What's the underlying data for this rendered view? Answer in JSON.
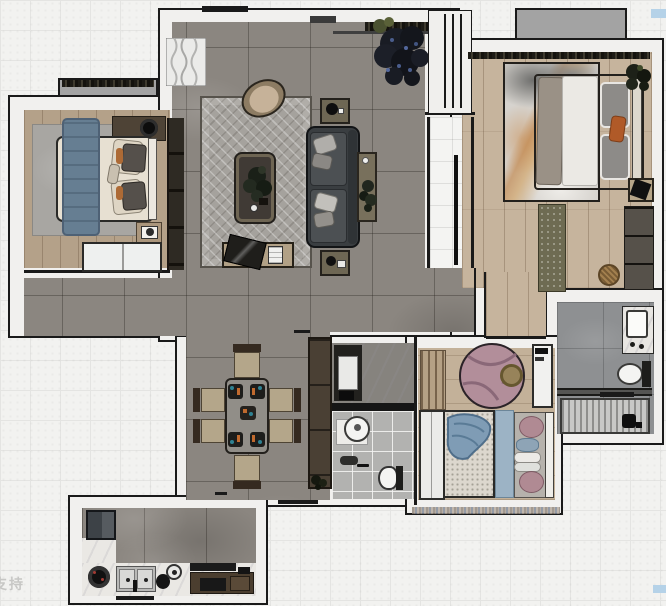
{
  "document": {
    "type": "apartment-floor-plan-render",
    "view": "top-down",
    "watermark": {
      "bottom_left": "支持"
    }
  },
  "palette": {
    "wall_fill": "#f1f0ee",
    "wall_outline": "#1a1a1a",
    "living_floor": "#8b8680",
    "wood_master": "#c6b49d",
    "wood_bedroom": "#b4a189",
    "rug_living": "#a5a29d",
    "sofa": "#3a3e41",
    "accent_orange": "#b4662e",
    "accent_blue": "#7f9cb5",
    "kids_rug_pink": "#b28e9a",
    "bay_window": "#a3a3a3",
    "exterior_tile": "#f2f2f0",
    "artifact_blue": "#b5d2e8"
  },
  "rooms": [
    {
      "name": "living-room",
      "floor": "gray-marble-tile",
      "furniture": [
        "curtain",
        "herringbone-rug",
        "armchair",
        "coffee-table",
        "coffee-table-plant",
        "tv-bench",
        "tv-panel",
        "media-item",
        "tv-wall-cabinet",
        "sofa",
        "sofa-cushions",
        "side-table-top",
        "side-table-bottom",
        "console-table",
        "console-plant",
        "large-potted-plant",
        "window-sill-planter",
        "entry-door-unit"
      ]
    },
    {
      "name": "bedroom-secondary",
      "floor": "wood-plank",
      "furniture": [
        "bay-window",
        "area-rug",
        "double-bed",
        "blue-throw-blanket",
        "pillows",
        "headboard",
        "top-counter-with-speaker",
        "nightstand-with-book",
        "white-dresser"
      ]
    },
    {
      "name": "master-bedroom",
      "floor": "wood-plank",
      "furniture": [
        "bay-window",
        "curtain-strip",
        "abstract-area-rug",
        "double-bed",
        "gray-blanket",
        "white-duvet",
        "pillows",
        "orange-accent-pillow",
        "headboard",
        "potted-plant",
        "nightstand-with-camera",
        "runner-rug",
        "wardrobe-panels",
        "rattan-basket"
      ]
    },
    {
      "name": "master-bathroom",
      "floor": "gray-tile",
      "furniture": [
        "vanity-sink",
        "toilet",
        "step-curb",
        "shower-slatted-floor",
        "shower-fixture"
      ]
    },
    {
      "name": "small-bathroom",
      "floor": "mixed-tile",
      "furniture": [
        "shower-tray",
        "black-fixture",
        "divider-counter",
        "round-basin",
        "vanity-counter",
        "toilet",
        "floor-mat"
      ]
    },
    {
      "name": "kids-bedroom",
      "floor": "wood-plank",
      "furniture": [
        "wardrobe-planks",
        "round-pink-rug",
        "ottoman",
        "desk-cabinet",
        "single-bed",
        "blue-drape",
        "blue-runner",
        "pillow-pink-1",
        "pillow-blue",
        "pillows-white",
        "pillow-pink-2",
        "white-wardrobe"
      ]
    },
    {
      "name": "dining-area",
      "floor": "gray-marble-tile",
      "furniture": [
        "dining-table",
        "place-setting-1",
        "place-setting-2",
        "place-setting-3",
        "place-setting-4",
        "center-setting",
        "dining-chair-top",
        "dining-chair-bottom",
        "dining-chair-left-1",
        "dining-chair-left-2",
        "dining-chair-right-1",
        "dining-chair-right-2",
        "storage-cabinet-column",
        "cabinet-plant"
      ]
    },
    {
      "name": "kitchen",
      "floor": "gray-marble-tile",
      "furniture": [
        "fridge",
        "marble-counter-left",
        "marble-counter-bottom",
        "gas-burner",
        "double-sink",
        "kettle",
        "plate",
        "range-hood",
        "base-cabinets",
        "cooktop",
        "window-bar"
      ]
    },
    {
      "name": "entry-hallway",
      "floor": "white-tile",
      "furniture": [
        "door-leaf"
      ]
    }
  ],
  "artifacts": {
    "blue_mark_top_right": "#b5d2e8",
    "blue_mark_bottom_right": "#b5d2e8"
  }
}
